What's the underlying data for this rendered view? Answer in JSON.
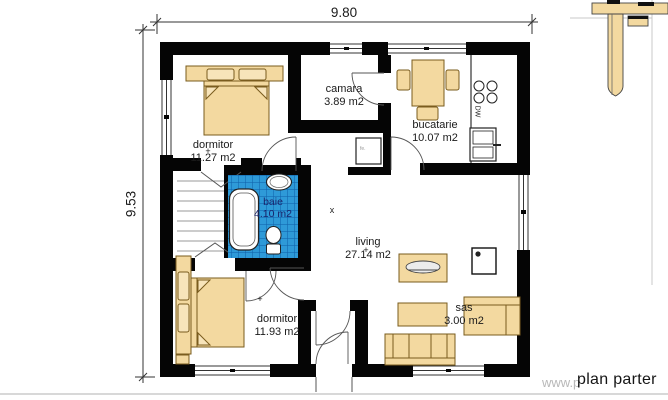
{
  "sheet": {
    "title": "plan parter",
    "watermark": "www.p"
  },
  "dimensions": {
    "width": "9.80",
    "height": "9.53"
  },
  "rooms": [
    {
      "name": "dormitor",
      "area": "11.27 m2"
    },
    {
      "name": "camara",
      "area": "3.89 m2"
    },
    {
      "name": "bucatarie",
      "area": "10.07 m2"
    },
    {
      "name": "baie",
      "area": "4.10 m2"
    },
    {
      "name": "living",
      "area": "27.14 m2"
    },
    {
      "name": "dormitor",
      "area": "11.93 m2"
    },
    {
      "name": "sas",
      "area": "3.00 m2"
    }
  ],
  "appliances": {
    "dishwasher": "DW",
    "heater": "fe."
  },
  "markers": [
    {
      "glyph": "+"
    },
    {
      "glyph": "+"
    },
    {
      "glyph": "+"
    },
    {
      "glyph": "x"
    }
  ],
  "colors": {
    "wall": "#050505",
    "furniture": "#f3d9a0",
    "furniture_light": "#f7e4ba",
    "tile_blue": "#2e9ad8",
    "tile_grid": "#0f5fa8",
    "baie_text": "#19246b",
    "watermark_gray": "#b8b8b8",
    "text": "#1a1a1a"
  }
}
